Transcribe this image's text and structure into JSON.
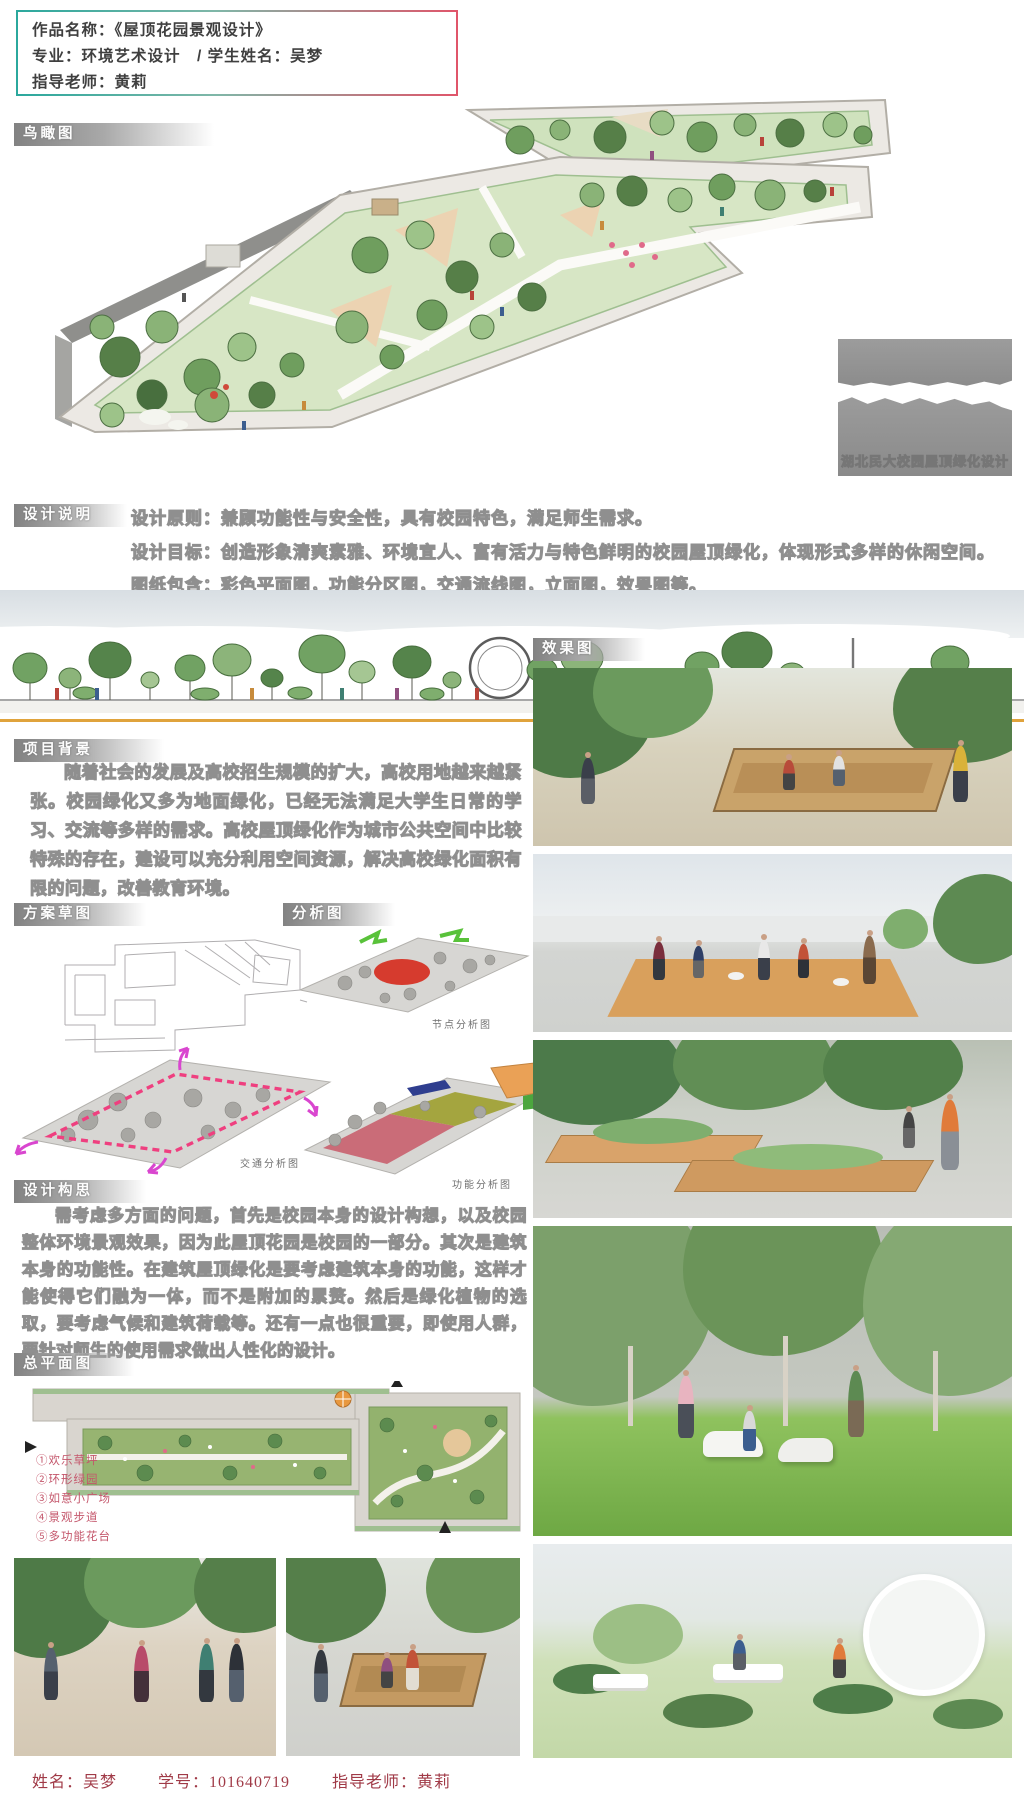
{
  "header": {
    "line1": "作品名称：《屋顶花园景观设计》",
    "line2": "专业：环境艺术设计　/ 学生姓名：吴梦",
    "line3": "指导老师：黄莉"
  },
  "labels": {
    "birdseye": "鸟瞰图",
    "design_notes": "设计说明",
    "project_background": "项目背景",
    "sketch": "方案草图",
    "analysis": "分析图",
    "renders": "效果图",
    "design_concept": "设计构思",
    "master_plan": "总平面图"
  },
  "banner_text": "湖北民大校园屋顶绿化设计",
  "design_notes": {
    "principle": "设计原则：兼顾功能性与安全性，具有校园特色，满足师生需求。",
    "goal": "设计目标：创造形象清爽素雅、环境宜人、富有活力与特色鲜明的校园屋顶绿化，体现形式多样的休闲空间。",
    "drawings": "图纸包含：彩色平面图，功能分区图，交通流线图，立面图，效果图等。"
  },
  "project_background_text": "随着社会的发展及高校招生规模的扩大，高校用地越来越紧张。校园绿化又多为地面绿化，已经无法满足大学生日常的学习、交流等多样的需求。高校屋顶绿化作为城市公共空间中比较特殊的存在，建设可以充分利用空间资源，解决高校绿化面积有限的问题，改善教育环境。",
  "design_concept_text": "需考虑多方面的问题，首先是校园本身的设计构想，以及校园整体环境景观效果，因为此屋顶花园是校园的一部分。其次是建筑本身的功能性。在建筑屋顶绿化是要考虑建筑本身的功能，这样才能使得它们融为一体，而不是附加的累赘。然后是绿化植物的选取，要考虑气候和建筑荷载等。还有一点也很重要，即使用人群，要针对师生的使用需求做出人性化的设计。",
  "analysis_captions": {
    "node": "节点分析图",
    "traffic": "交通分析图",
    "function": "功能分析图"
  },
  "master_plan_legend": [
    "①欢乐草坪",
    "②环形绿园",
    "③如意小广场",
    "④景观步道",
    "⑤多功能花台"
  ],
  "footer": {
    "name": "姓名：吴梦",
    "student_id": "学号：101640719",
    "teacher": "指导老师：黄莉"
  },
  "colors": {
    "accent_teal": "#2ba89d",
    "accent_red": "#e0556a",
    "label_gray": "#8a8a8a",
    "legend_red": "#c4566b",
    "footer_red": "#a03a47",
    "rule_orange": "#e0a33c"
  }
}
